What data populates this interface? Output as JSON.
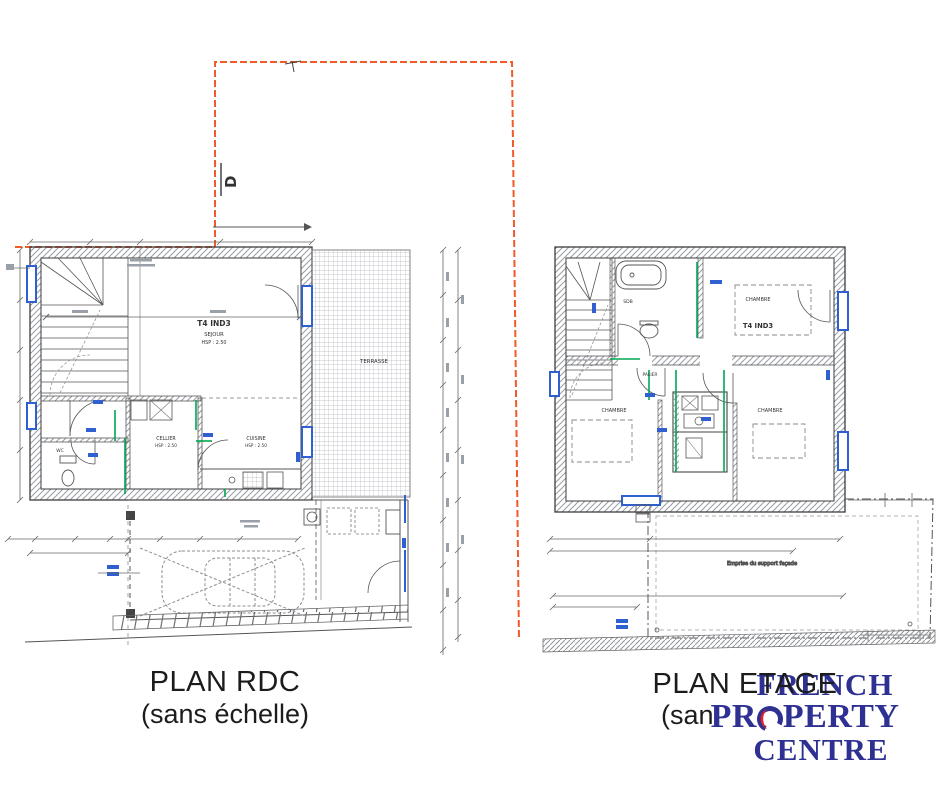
{
  "captions": {
    "rdc_title": "PLAN RDC",
    "rdc_subtitle": "(sans échelle)",
    "etage_title": "PLAN ETAGE",
    "etage_subtitle": "(sans échelle)"
  },
  "logo": {
    "line1": "FRENCH",
    "line2_left": "PR",
    "line2_right": "PERTY",
    "line3": "CENTRE",
    "navy": "#2e3192",
    "red": "#e31e26"
  },
  "rdc": {
    "unit": "T4 IND3",
    "sejour": "SEJOUR",
    "hsp": "HSP : 2.50",
    "cellier": "CELLIER",
    "cellier_hsp": "HSP : 2.50",
    "cuisine": "CUISINE",
    "cuisine_hsp": "HSP : 2.50",
    "terrasse": "TERRASSE",
    "wc": "WC",
    "section_label": "D"
  },
  "etage": {
    "unit": "T4 IND3",
    "chambre1": "CHAMBRE",
    "chambre2": "CHAMBRE",
    "chambre3": "CHAMBRE",
    "sdb": "SDB",
    "palier": "PALIER",
    "annex_note": "Emprise du support façade"
  },
  "colors": {
    "boundary": "#f15a29",
    "accent_blue": "#2f5fd0",
    "accent_green": "#00a651"
  }
}
